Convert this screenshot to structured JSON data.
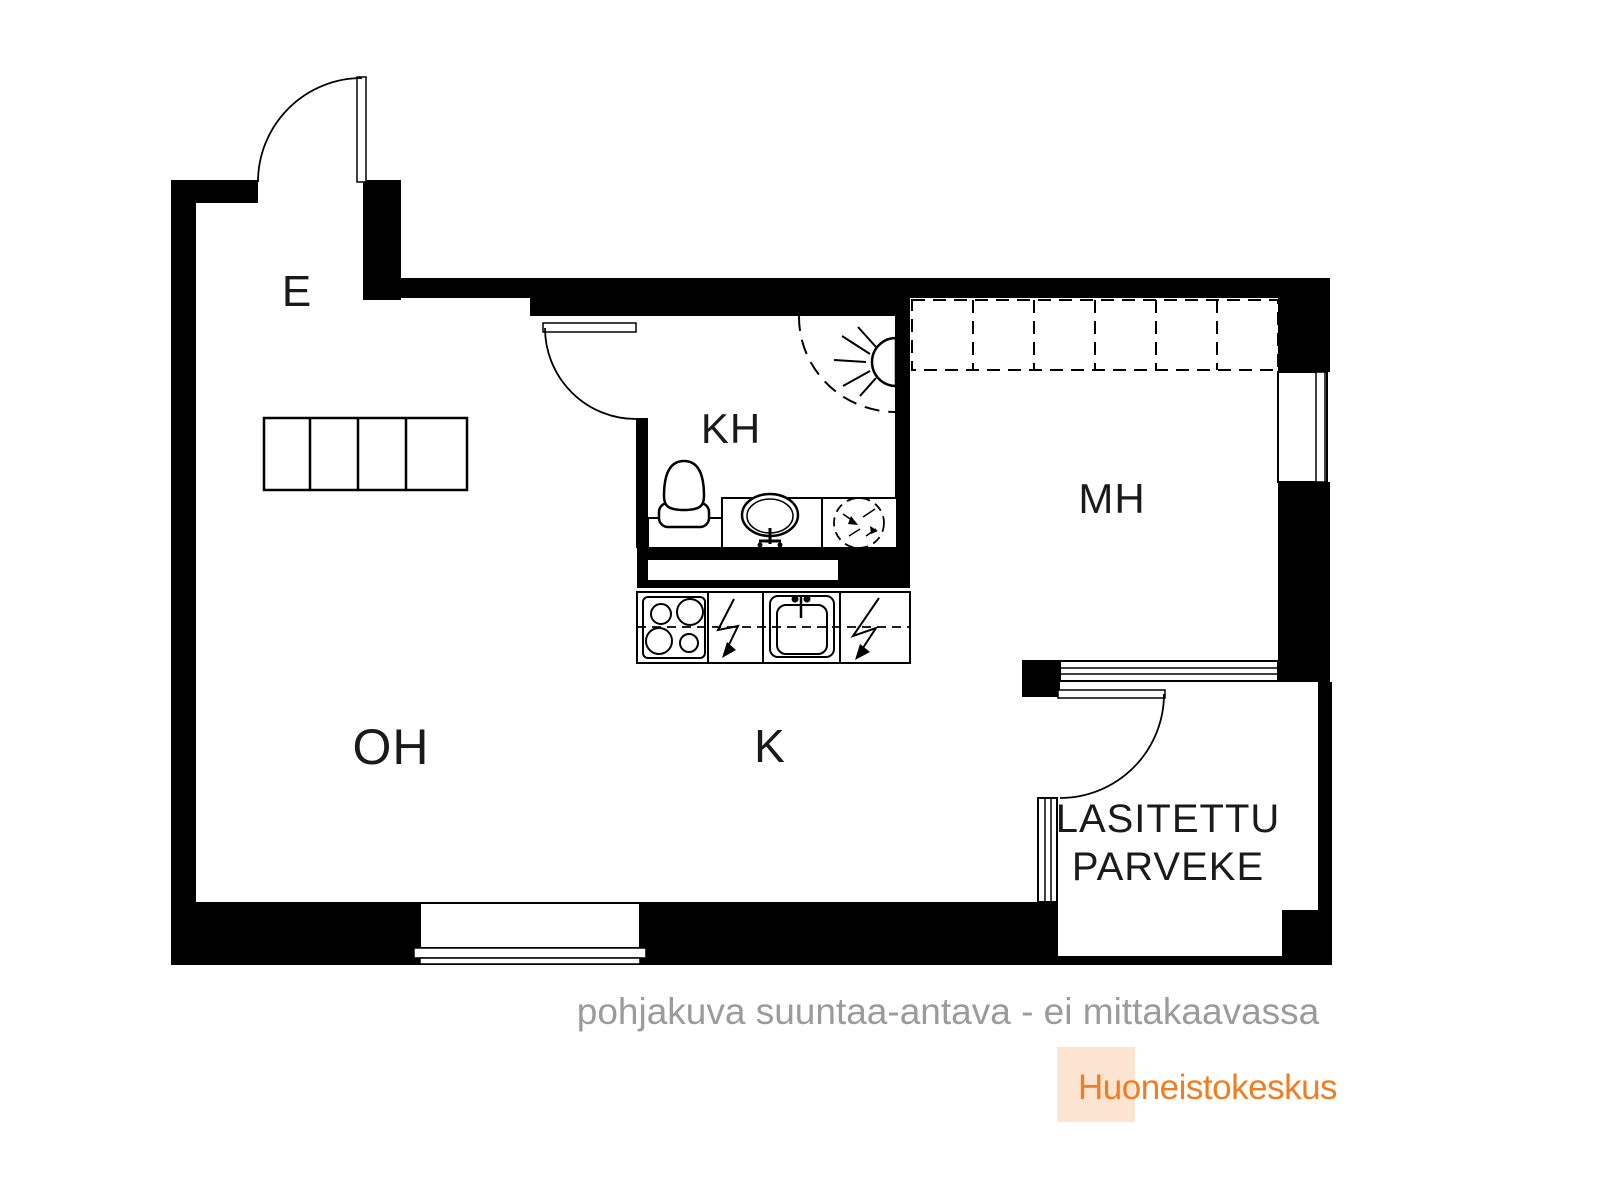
{
  "plan": {
    "labels": {
      "e": "E",
      "kh": "KH",
      "mh": "MH",
      "oh": "OH",
      "k": "K",
      "balcony_line1": "LASITETTU",
      "balcony_line2": "PARVEKE"
    },
    "fixtures": {
      "entrance_door": "entrance-door",
      "bathroom_door": "bathroom-door",
      "balcony_door": "balcony-door",
      "hall_wardrobe": "wardrobe-4-sections",
      "bedroom_wardrobe": "wardrobe-6-sections-dashed",
      "toilet": "toilet-icon",
      "washbasin": "washbasin-icon",
      "washing_machine": "washing-machine-reservation-icon",
      "shower": "shower-icon",
      "stove": "stove-icon",
      "kitchen_sink": "kitchen-sink-icon",
      "appliance_reservation": "lightning-bolt-icon",
      "windows": [
        "living-room-window",
        "bedroom-window",
        "balcony-window-top",
        "balcony-window-left"
      ]
    }
  },
  "footer": {
    "disclaimer": "pohjakuva suuntaa-antava - ei mittakaavassa",
    "brand": "Huoneistokeskus"
  },
  "colors": {
    "wall": "#000000",
    "label_text": "#1a1a1a",
    "disclaimer_gray": "#9b9b9b",
    "brand_orange": "#f07d1f",
    "brand_bg": "#fbe5d2"
  }
}
